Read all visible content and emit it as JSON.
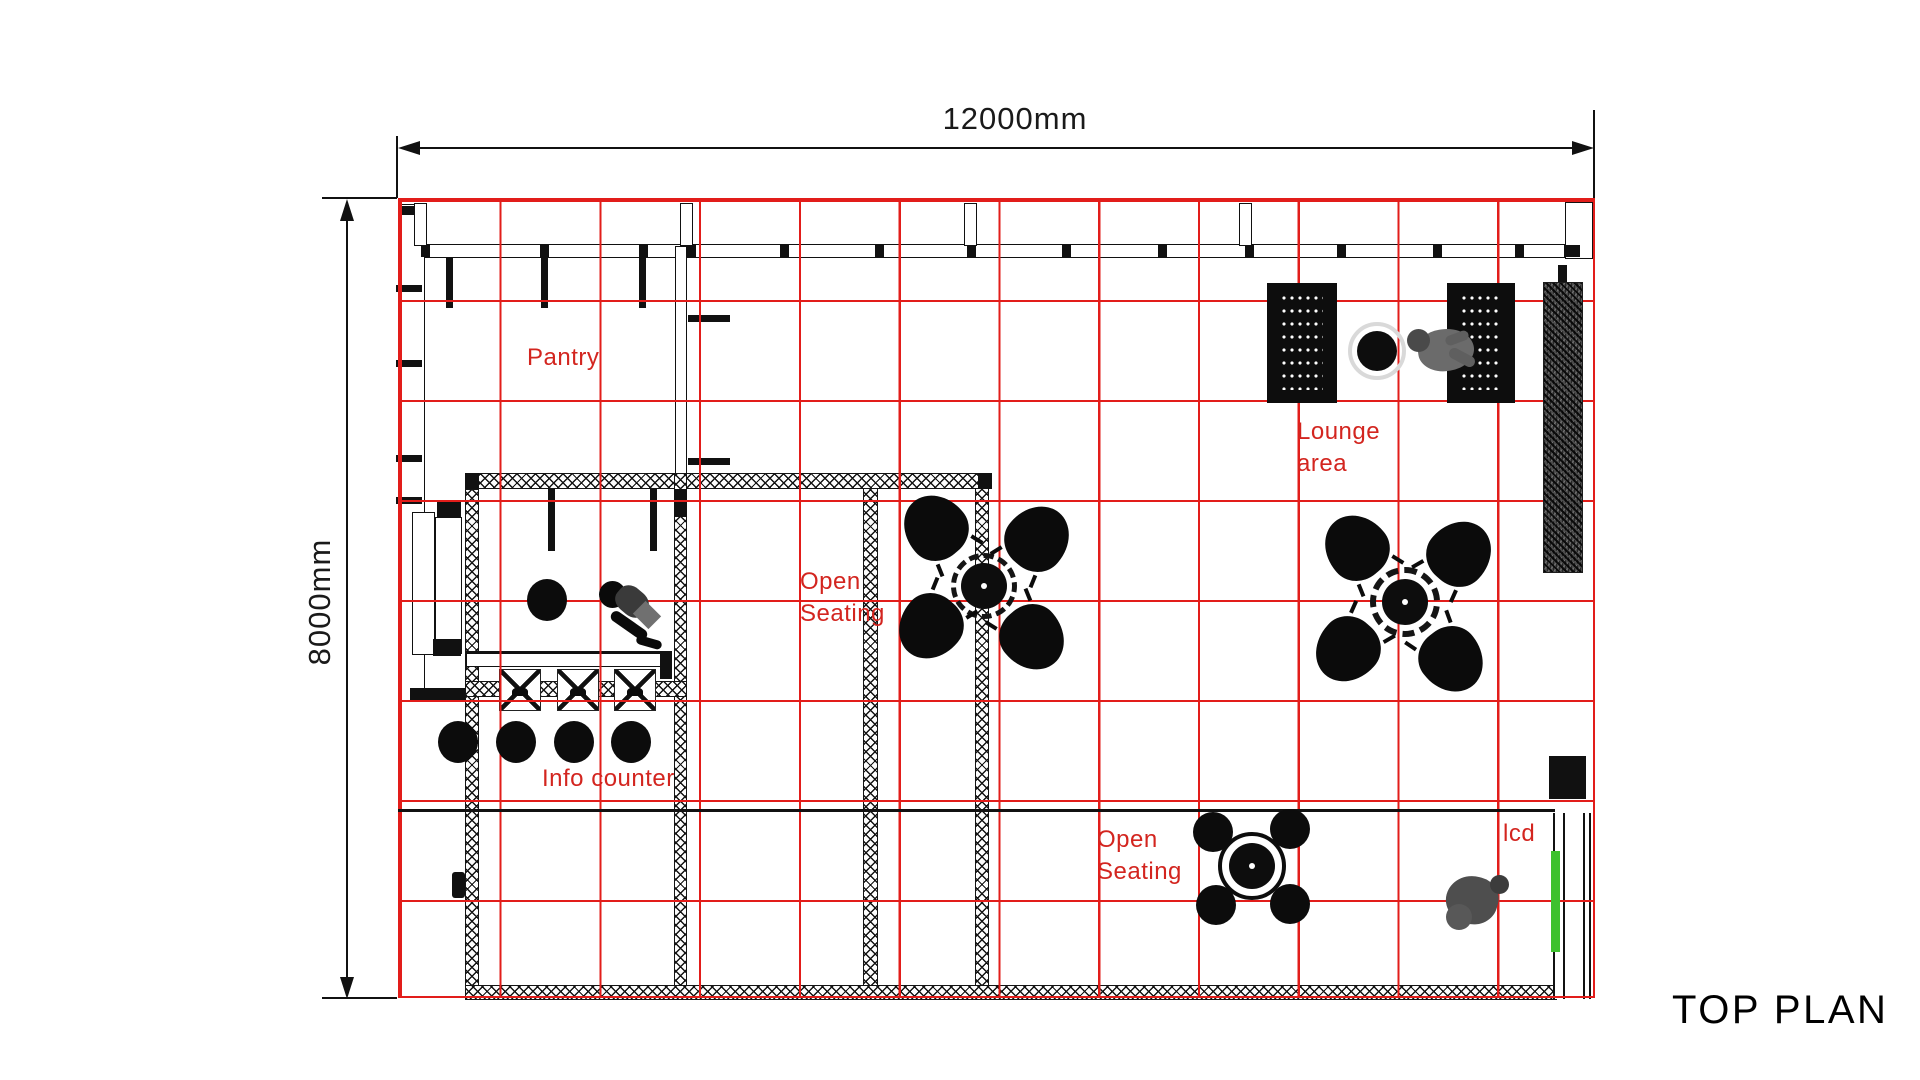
{
  "title": {
    "text": "TOP PLAN"
  },
  "dimensions": {
    "horizontal": "12000mm",
    "vertical": "8000mm"
  },
  "areas": {
    "pantry": "Pantry",
    "info_counter": "Info counter",
    "open_seating_1": [
      "Open",
      "Seating"
    ],
    "open_seating_2": [
      "Open",
      "Seating"
    ],
    "lounge": [
      "Lounge",
      "area"
    ],
    "lcd": "lcd"
  },
  "colors": {
    "grid_red": "#e21d1a",
    "label_red": "#d3251f",
    "ink": "#111111",
    "green_accent": "#3ec12e"
  }
}
